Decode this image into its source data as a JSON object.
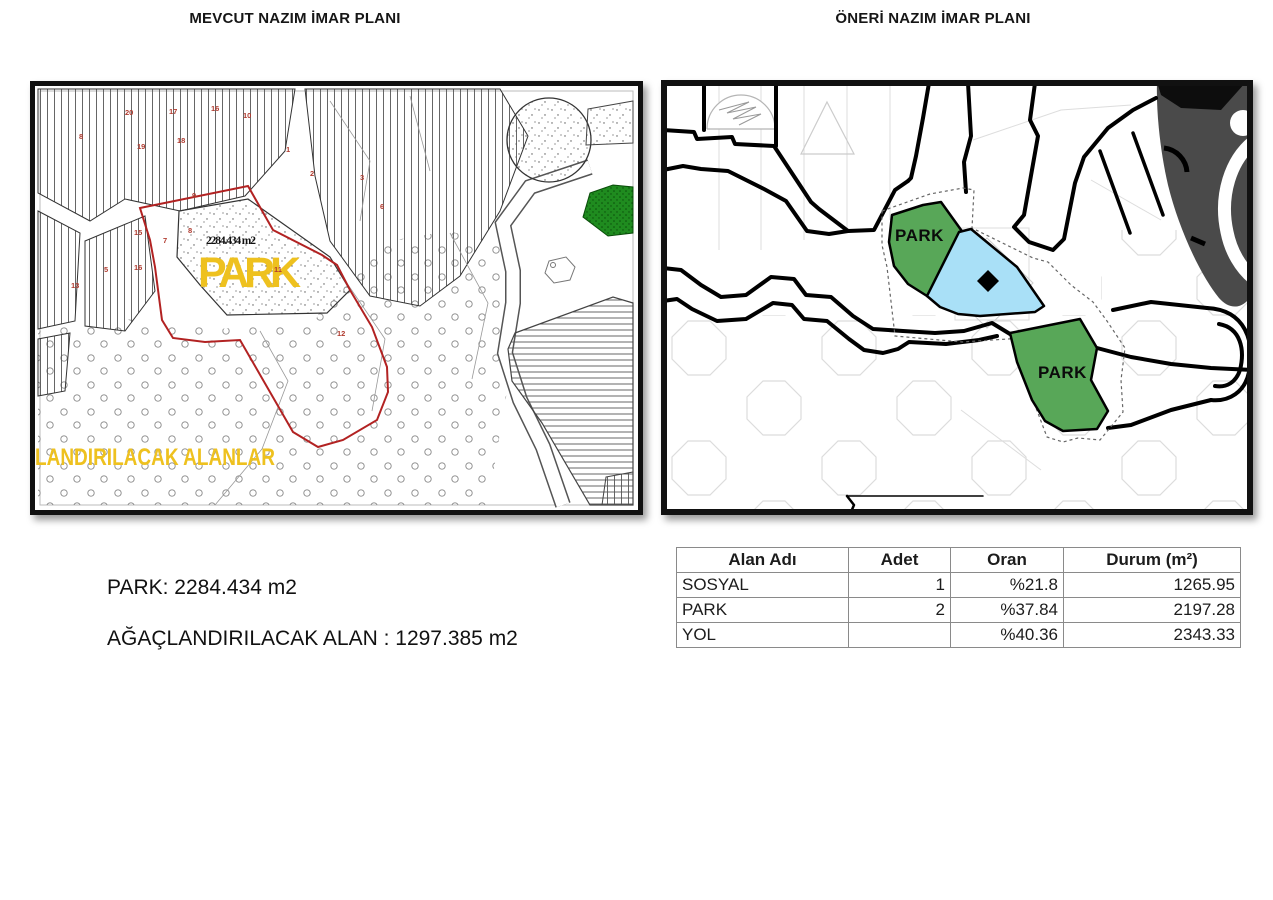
{
  "page": {
    "left_title": "MEVCUT NAZIM İMAR PLANI",
    "right_title": "ÖNERİ NAZIM İMAR PLANI"
  },
  "left_map": {
    "park_label": "PARK",
    "area_label": "2284.434 m2",
    "bottom_label": "LANDIRILACAK ALANLAR",
    "parcel_numbers": [
      "20",
      "17",
      "16",
      "10",
      "19",
      "18",
      "8",
      "1",
      "2",
      "3",
      "15",
      "16",
      "5",
      "13",
      "7",
      "9",
      "8",
      "12",
      "6",
      "11"
    ],
    "colors": {
      "highlight_yellow": "#eec11f",
      "boundary_red": "#b22222",
      "green_area": "#1f8b1f"
    }
  },
  "right_map": {
    "park1_label": "PARK",
    "park2_label": "PARK",
    "colors": {
      "park_green": "#58a758",
      "sosyal_blue": "#a9e0f7",
      "dark_area": "#4a4a4a"
    }
  },
  "summary": {
    "line1": "PARK: 2284.434 m2",
    "line2": "AĞAÇLANDIRILACAK ALAN : 1297.385 m2"
  },
  "table": {
    "headers": [
      "Alan Adı",
      "Adet",
      "Oran",
      "Durum (m²)"
    ],
    "rows": [
      {
        "alan": "SOSYAL",
        "adet": "1",
        "oran": "%21.8",
        "durum": "1265.95"
      },
      {
        "alan": "PARK",
        "adet": "2",
        "oran": "%37.84",
        "durum": "2197.28"
      },
      {
        "alan": "YOL",
        "adet": "",
        "oran": "%40.36",
        "durum": "2343.33"
      }
    ]
  }
}
